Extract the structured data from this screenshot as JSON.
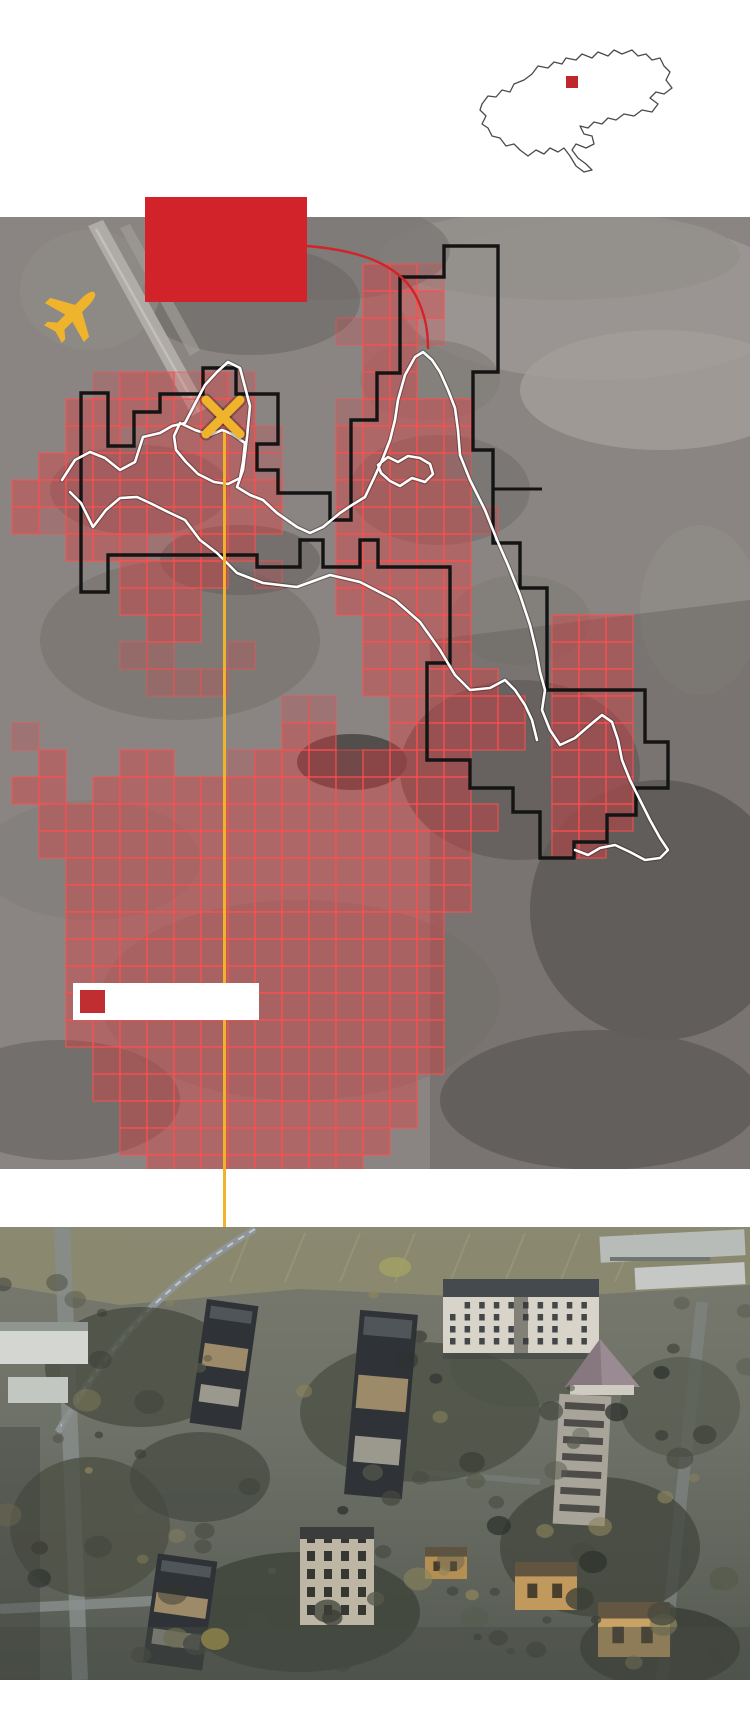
{
  "page": {
    "width": 750,
    "height": 1732,
    "background": "#ffffff"
  },
  "colors": {
    "accent_red": "#D2232A",
    "marker_gold": "#F0B42C",
    "damage_fill": "#E23A3F",
    "damage_stroke": "#FF5050",
    "boundary_black": "#141414",
    "frontline_white": "#FFFFFF",
    "legend_swatch": "#C12E31",
    "sat_base": "#8A8582",
    "photo_base": "#6E7167",
    "locator_outline": "#4A4A4A",
    "locator_marker": "#C0272D"
  },
  "locator": {
    "marker": {
      "x": 92,
      "y": 36,
      "w": 12,
      "h": 12
    }
  },
  "callout": {
    "label": "",
    "leader_path": "M307,246 C355,250 398,262 416,296 C426,316 428,332 428,349"
  },
  "legend": {
    "label": ""
  },
  "map": {
    "grid": {
      "origin_x": 12,
      "origin_y": 21,
      "cell": 27,
      "first_row": 9,
      "rows": [
        ".............112..............",
        ".............111............",
        "............2112............",
        ".............11..............",
        "...211212....11..............",
        "..1111111...21111...........",
        "..11211112..11111...........",
        ".111111112..11112...........",
        "1111111111..11111...........",
        "1211111111..111112..........",
        "..1112111...11111...........",
        "....1111.2..11111...........",
        "....111.....11111...........",
        ".....11......1111...111.....",
        "....22..2....1111...111.....",
        ".....222.....11111..111.....",
        "..........22..11111.111.....",
        "2.........11..11111.111.....",
        ".1..11..211121111...111.....",
        "11.11111111111111...111.....",
        ".11111111111111111..111.....",
        ".1111111111111111...11......",
        "..111111111111111...........",
        "..111111111111111...........",
        "..11111111111111............",
        "..11111111111111............",
        "..11111111111111............",
        "..11111111111111............",
        "..11111111111111............",
        "...1111111111111............",
        "...111111111111.............",
        "....11111111111.............",
        "....1111111111..............",
        ".....11111111..............."
      ]
    },
    "black_boundary": [
      [
        81,
        393
      ],
      [
        108,
        393
      ],
      [
        108,
        446
      ],
      [
        134,
        446
      ],
      [
        134,
        412
      ],
      [
        160,
        412
      ],
      [
        160,
        394
      ],
      [
        203,
        394
      ],
      [
        203,
        368
      ],
      [
        236,
        368
      ],
      [
        236,
        394
      ],
      [
        278,
        394
      ],
      [
        278,
        444
      ],
      [
        257,
        444
      ],
      [
        257,
        470
      ],
      [
        278,
        470
      ],
      [
        278,
        493
      ],
      [
        330,
        493
      ],
      [
        330,
        520
      ],
      [
        351,
        520
      ],
      [
        351,
        420
      ],
      [
        377,
        420
      ],
      [
        377,
        373
      ],
      [
        400,
        373
      ],
      [
        400,
        277
      ],
      [
        444,
        277
      ],
      [
        444,
        246
      ],
      [
        498,
        246
      ],
      [
        498,
        372
      ],
      [
        473,
        372
      ],
      [
        473,
        450
      ],
      [
        493,
        450
      ],
      [
        493,
        543
      ],
      [
        520,
        543
      ],
      [
        520,
        588
      ],
      [
        547,
        588
      ],
      [
        547,
        690
      ],
      [
        645,
        690
      ],
      [
        645,
        742
      ],
      [
        668,
        742
      ],
      [
        668,
        788
      ],
      [
        636,
        788
      ],
      [
        636,
        815
      ],
      [
        607,
        815
      ],
      [
        607,
        842
      ],
      [
        574,
        842
      ],
      [
        574,
        858
      ],
      [
        540,
        858
      ],
      [
        540,
        812
      ],
      [
        513,
        812
      ],
      [
        513,
        788
      ],
      [
        470,
        788
      ],
      [
        470,
        760
      ],
      [
        427,
        760
      ],
      [
        427,
        663
      ],
      [
        450,
        663
      ],
      [
        450,
        567
      ],
      [
        378,
        567
      ],
      [
        378,
        540
      ],
      [
        360,
        540
      ],
      [
        360,
        567
      ],
      [
        323,
        567
      ],
      [
        323,
        540
      ],
      [
        300,
        540
      ],
      [
        300,
        567
      ],
      [
        257,
        567
      ],
      [
        257,
        555
      ],
      [
        108,
        555
      ],
      [
        108,
        592
      ],
      [
        81,
        592
      ]
    ],
    "black_stub": [
      [
        493,
        489
      ],
      [
        542,
        489
      ]
    ],
    "white_paths": [
      [
        [
          62,
          480
        ],
        [
          75,
          460
        ],
        [
          90,
          452
        ],
        [
          105,
          458
        ],
        [
          120,
          470
        ],
        [
          135,
          462
        ],
        [
          143,
          437
        ],
        [
          160,
          433
        ],
        [
          172,
          426
        ],
        [
          185,
          423
        ],
        [
          197,
          400
        ],
        [
          205,
          385
        ],
        [
          217,
          372
        ],
        [
          228,
          362
        ],
        [
          240,
          368
        ],
        [
          250,
          406
        ],
        [
          247,
          437
        ],
        [
          243,
          470
        ],
        [
          237,
          487
        ],
        [
          250,
          495
        ],
        [
          263,
          500
        ],
        [
          277,
          513
        ],
        [
          297,
          527
        ],
        [
          310,
          533
        ],
        [
          323,
          527
        ],
        [
          340,
          513
        ],
        [
          352,
          505
        ],
        [
          365,
          497
        ],
        [
          374,
          478
        ],
        [
          383,
          458
        ],
        [
          390,
          440
        ],
        [
          395,
          420
        ],
        [
          398,
          400
        ],
        [
          405,
          375
        ],
        [
          415,
          357
        ],
        [
          423,
          352
        ],
        [
          432,
          360
        ],
        [
          440,
          372
        ],
        [
          448,
          390
        ],
        [
          455,
          408
        ],
        [
          458,
          430
        ],
        [
          460,
          455
        ],
        [
          470,
          480
        ],
        [
          485,
          510
        ],
        [
          497,
          540
        ],
        [
          508,
          565
        ],
        [
          520,
          595
        ],
        [
          530,
          625
        ],
        [
          536,
          650
        ],
        [
          540,
          672
        ],
        [
          545,
          690
        ],
        [
          542,
          710
        ],
        [
          550,
          730
        ],
        [
          560,
          745
        ],
        [
          575,
          738
        ],
        [
          590,
          725
        ],
        [
          602,
          715
        ],
        [
          612,
          722
        ],
        [
          618,
          740
        ],
        [
          622,
          760
        ],
        [
          630,
          780
        ],
        [
          640,
          800
        ],
        [
          650,
          820
        ],
        [
          660,
          838
        ],
        [
          668,
          850
        ],
        [
          660,
          858
        ],
        [
          645,
          860
        ],
        [
          630,
          852
        ],
        [
          615,
          845
        ],
        [
          600,
          848
        ],
        [
          588,
          855
        ],
        [
          575,
          850
        ]
      ],
      [
        [
          70,
          492
        ],
        [
          81,
          503
        ],
        [
          93,
          527
        ],
        [
          106,
          510
        ],
        [
          120,
          498
        ],
        [
          137,
          497
        ],
        [
          152,
          504
        ],
        [
          168,
          512
        ],
        [
          185,
          520
        ],
        [
          200,
          540
        ],
        [
          217,
          553
        ],
        [
          237,
          573
        ],
        [
          263,
          583
        ],
        [
          297,
          587
        ],
        [
          330,
          575
        ],
        [
          360,
          582
        ],
        [
          395,
          600
        ],
        [
          420,
          622
        ],
        [
          440,
          650
        ],
        [
          455,
          675
        ],
        [
          470,
          690
        ],
        [
          490,
          688
        ],
        [
          505,
          680
        ],
        [
          515,
          690
        ],
        [
          525,
          705
        ],
        [
          532,
          720
        ],
        [
          537,
          740
        ]
      ],
      [
        [
          378,
          465
        ],
        [
          388,
          457
        ],
        [
          398,
          462
        ],
        [
          408,
          456
        ],
        [
          420,
          458
        ],
        [
          430,
          464
        ],
        [
          433,
          474
        ],
        [
          425,
          482
        ],
        [
          412,
          478
        ],
        [
          400,
          486
        ],
        [
          390,
          481
        ],
        [
          381,
          473
        ],
        [
          378,
          465
        ]
      ],
      [
        [
          180,
          423
        ],
        [
          195,
          430
        ],
        [
          210,
          435
        ],
        [
          222,
          430
        ],
        [
          232,
          434
        ],
        [
          245,
          443
        ],
        [
          243,
          462
        ],
        [
          240,
          478
        ],
        [
          228,
          484
        ],
        [
          214,
          482
        ],
        [
          198,
          474
        ],
        [
          186,
          462
        ],
        [
          176,
          450
        ],
        [
          174,
          436
        ],
        [
          180,
          423
        ]
      ]
    ],
    "markers": {
      "plane": {
        "x": 75,
        "y": 312,
        "rotation": 45,
        "scale": 1.25
      },
      "x_marker": {
        "x": 223,
        "y": 417,
        "half": 17,
        "stroke_w": 9
      },
      "target_line": {
        "x": 224.5,
        "y1": 432,
        "y2": 1227
      }
    }
  }
}
